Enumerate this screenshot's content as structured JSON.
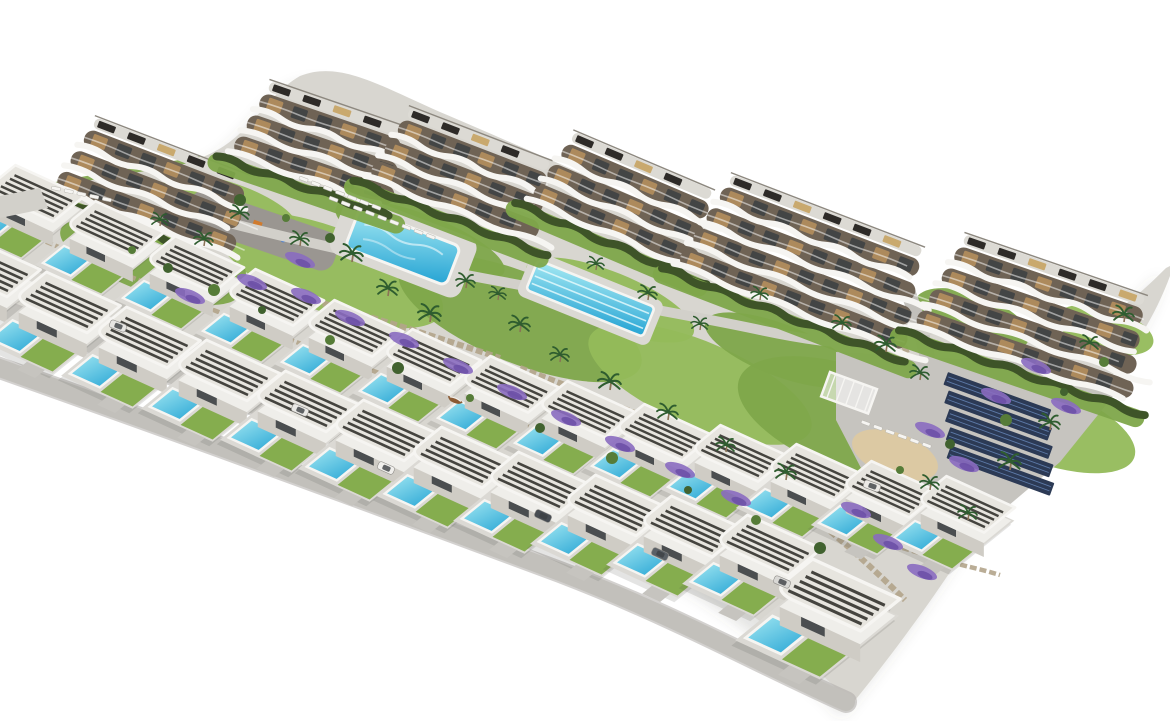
{
  "scene": {
    "kind": "aerial-architectural-render",
    "description": "Aerial 3D render of a hillside residential development on a pure white background: six curved white apartment blocks with wavy balcony bands along the top, two staggered rows of detached white flat-roof villas with slatted pergolas and private turquoise pools, two communal pools, landscaped terraces with lavender and palms, a playground, a sand lounge area and a solar-panel car park on the right.",
    "inventory": {
      "apartment_buildings": 6,
      "detached_villas": 25,
      "private_pools": 25,
      "communal_pools": 2,
      "lap_pool_lanes": 4,
      "solar_carport_rows": 5,
      "playground_areas": 1,
      "parking_areas": 1,
      "sand_lounge_areas": 1
    },
    "palette": {
      "bg": "#ffffff",
      "shadow": "rgba(90,88,80,0.16)",
      "ground": "#d8d6d0",
      "plot": "#dbd9d4",
      "drive": "#c6c4bf",
      "road": "#c2c0bb",
      "roadEdge": "#aeaca7",
      "walk": "#d2d0ca",
      "lawn": "#7ea64a",
      "lawn2": "#85ad4e",
      "lawnLight": "#93ba5a",
      "hedge": "#3e5428",
      "facade": "#6f6355",
      "furn": "#b9905e",
      "win": "#3c4043",
      "fascia": "#f6f5f2",
      "roof": "#dcdad4",
      "deck": "#c9a96e",
      "solarRoof": "#2e2b28",
      "solar": "#2c3a55",
      "solarStripe": "#5d7aa8",
      "villaWall": "#cfccc5",
      "villaTop": "#efeeea",
      "villaRoof": "#e7e5df",
      "slat": "#45443f",
      "stone": "#b3a58b",
      "sand": "#dcc9a3",
      "lavender": "#8a6cc0",
      "lavender2": "#6b4fa6",
      "palm": "#2f5d2f",
      "trunk": "#8a7356",
      "playground": "#9a9691",
      "poolA": "#a5e9f3",
      "poolB": "#2fa9d6"
    },
    "buildings": [
      {
        "x": 88,
        "y": 128,
        "len": 170,
        "floors": 3,
        "rot": 21
      },
      {
        "x": 263,
        "y": 92,
        "len": 148,
        "floors": 3,
        "rot": 19
      },
      {
        "x": 402,
        "y": 118,
        "len": 158,
        "floors": 3,
        "rot": 21
      },
      {
        "x": 566,
        "y": 142,
        "len": 158,
        "floors": 3,
        "rot": 23
      },
      {
        "x": 724,
        "y": 185,
        "len": 212,
        "floors": 4,
        "rot": 21
      },
      {
        "x": 958,
        "y": 245,
        "len": 198,
        "floors": 4,
        "rot": 19
      }
    ],
    "villa_rows": [
      {
        "scale": 1.02,
        "items": [
          [
            15,
            180
          ],
          [
            95,
            216
          ],
          [
            175,
            251
          ],
          [
            255,
            284
          ],
          [
            334,
            315
          ],
          [
            412,
            344
          ],
          [
            490,
            371
          ],
          [
            567,
            396
          ],
          [
            644,
            419
          ],
          [
            720,
            440
          ],
          [
            796,
            459
          ],
          [
            871,
            476
          ],
          [
            946,
            491
          ]
        ]
      },
      {
        "scale": 1.1,
        "items": [
          [
            -34,
            252
          ],
          [
            46,
            288
          ],
          [
            126,
            323
          ],
          [
            206,
            356
          ],
          [
            285,
            387
          ],
          [
            363,
            416
          ],
          [
            441,
            443
          ],
          [
            518,
            468
          ],
          [
            595,
            491
          ],
          [
            671,
            512
          ],
          [
            747,
            531
          ]
        ]
      }
    ],
    "villa_big": {
      "x": 812,
      "y": 578,
      "scale": 1.3
    },
    "pools": {
      "leisure": {
        "x": 360,
        "y": 208,
        "rot": 21,
        "w": 108,
        "h": 42
      },
      "lap": {
        "x": 538,
        "y": 260,
        "rot": 22,
        "w": 126,
        "h": 32,
        "lanes": 4
      }
    },
    "solar_park": {
      "x": 948,
      "y": 372,
      "rot": 20,
      "rows": 5,
      "w": 110,
      "h": 13.5,
      "dy": 17,
      "dx": 7
    },
    "lounger_rows": [
      {
        "x": 330,
        "y": 196,
        "rot": 21,
        "count": 9
      },
      {
        "x": 300,
        "y": 176,
        "rot": 21,
        "count": 7
      },
      {
        "x": 862,
        "y": 420,
        "rot": 20,
        "count": 6
      },
      {
        "x": 52,
        "y": 186,
        "rot": 12,
        "count": 5
      }
    ],
    "lawns": [
      [
        150,
        262,
        95,
        30,
        20
      ],
      [
        330,
        270,
        120,
        42,
        21
      ],
      [
        520,
        318,
        130,
        45,
        22
      ],
      [
        700,
        384,
        120,
        42,
        23
      ],
      [
        852,
        420,
        120,
        52,
        20
      ],
      [
        1045,
        425,
        95,
        38,
        20
      ],
      [
        972,
        320,
        60,
        26,
        20
      ],
      [
        230,
        205,
        70,
        22,
        19
      ],
      [
        420,
        240,
        90,
        26,
        21
      ],
      [
        610,
        300,
        90,
        28,
        22
      ],
      [
        780,
        350,
        80,
        26,
        21
      ],
      [
        1105,
        330,
        50,
        22,
        16
      ]
    ],
    "palms": [
      [
        352,
        262,
        1.2
      ],
      [
        388,
        296,
        1.1
      ],
      [
        300,
        246,
        1.0
      ],
      [
        430,
        322,
        1.2
      ],
      [
        466,
        288,
        1.0
      ],
      [
        520,
        332,
        1.1
      ],
      [
        560,
        362,
        1.0
      ],
      [
        610,
        390,
        1.2
      ],
      [
        668,
        420,
        1.1
      ],
      [
        726,
        452,
        1.0
      ],
      [
        786,
        480,
        1.1
      ],
      [
        842,
        330,
        1.0
      ],
      [
        886,
        352,
        1.1
      ],
      [
        920,
        380,
        1.0
      ],
      [
        1010,
        470,
        1.2
      ],
      [
        1050,
        430,
        1.1
      ],
      [
        1090,
        350,
        1.0
      ],
      [
        1124,
        322,
        1.1
      ],
      [
        240,
        220,
        1.0
      ],
      [
        204,
        246,
        1.0
      ],
      [
        160,
        226,
        0.9
      ],
      [
        498,
        300,
        0.9
      ],
      [
        648,
        300,
        1.0
      ],
      [
        700,
        330,
        0.9
      ],
      [
        760,
        300,
        0.9
      ],
      [
        596,
        270,
        0.9
      ],
      [
        930,
        490,
        1.0
      ],
      [
        968,
        520,
        1.0
      ]
    ],
    "lavender": [
      [
        306,
        296
      ],
      [
        350,
        318
      ],
      [
        404,
        340
      ],
      [
        458,
        366
      ],
      [
        512,
        392
      ],
      [
        566,
        418
      ],
      [
        620,
        444
      ],
      [
        300,
        260
      ],
      [
        252,
        282
      ],
      [
        190,
        296
      ],
      [
        680,
        470
      ],
      [
        736,
        498
      ],
      [
        930,
        430
      ],
      [
        964,
        464
      ],
      [
        996,
        396
      ],
      [
        1036,
        366
      ],
      [
        1066,
        406
      ],
      [
        888,
        542
      ],
      [
        922,
        572
      ],
      [
        856,
        510
      ]
    ],
    "bushes": [
      [
        132,
        250
      ],
      [
        168,
        268
      ],
      [
        214,
        290
      ],
      [
        262,
        310
      ],
      [
        330,
        340
      ],
      [
        398,
        368
      ],
      [
        470,
        398
      ],
      [
        540,
        428
      ],
      [
        612,
        458
      ],
      [
        688,
        490
      ],
      [
        756,
        520
      ],
      [
        820,
        548
      ],
      [
        900,
        470
      ],
      [
        950,
        444
      ],
      [
        1006,
        420
      ],
      [
        1064,
        392
      ],
      [
        1104,
        362
      ],
      [
        240,
        200
      ],
      [
        286,
        218
      ],
      [
        330,
        238
      ]
    ],
    "cars": [
      [
        386,
        468,
        24,
        "#f0efec"
      ],
      [
        543,
        516,
        25,
        "#474c52"
      ],
      [
        300,
        410,
        23,
        "#e9e8e5"
      ],
      [
        660,
        554,
        25,
        "#5a6066"
      ],
      [
        118,
        326,
        21,
        "#e6e5e2"
      ],
      [
        782,
        582,
        23,
        "#d9d8d5"
      ],
      [
        872,
        486,
        20,
        "#eceae6"
      ]
    ],
    "boat": [
      448,
      396,
      23
    ]
  }
}
